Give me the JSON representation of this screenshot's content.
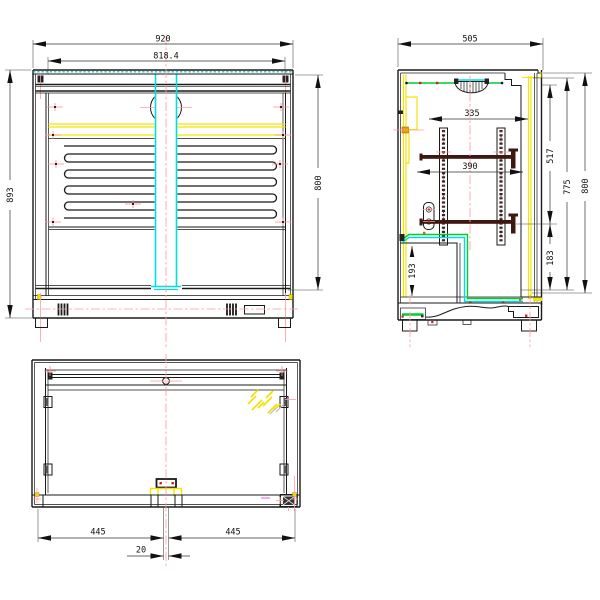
{
  "drawing": {
    "type": "technical-drawing",
    "subject": "back-bar cooler cabinet, three orthographic views",
    "units": "mm",
    "front_view": {
      "dim_overall_width": "920",
      "dim_inner_width": "818.4",
      "dim_overall_height": "893",
      "dim_body_height": "800"
    },
    "side_view": {
      "dim_depth": "505",
      "dim_shelf_span": "335",
      "dim_shelf_depth": "390",
      "dim_top_to_shelf": "517",
      "dim_interior_height": "775",
      "dim_body_height": "800",
      "dim_shelf_to_floor": "183",
      "dim_compartment_height": "193"
    },
    "bottom_view": {
      "dim_left_half": "445",
      "dim_right_half": "445",
      "dim_center_gap": "20"
    },
    "colors": {
      "line": "#1a1a1a",
      "centerline": "#ff9e9e",
      "accent_cyan": "#00dede",
      "accent_yellow": "#f2e400",
      "accent_green": "#00cc33",
      "marker_red": "#cc2222",
      "shelf_bar": "#3f1710",
      "magenta": "#ff6ef0"
    }
  }
}
